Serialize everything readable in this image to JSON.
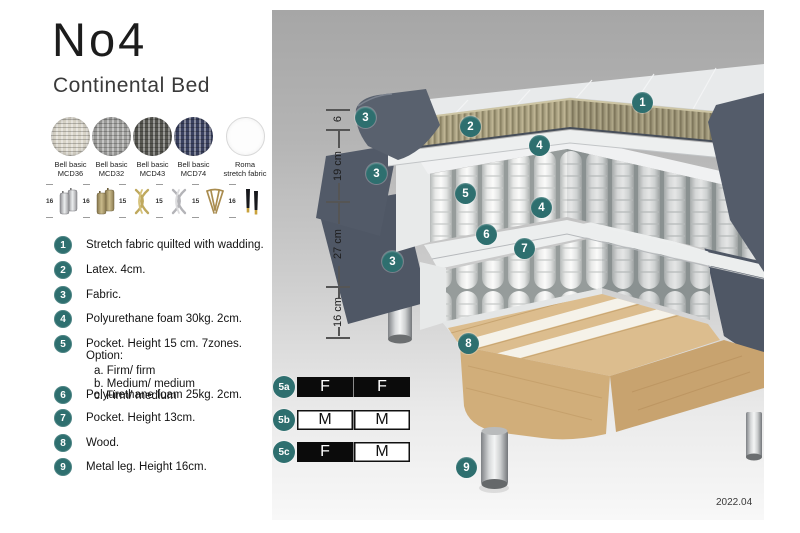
{
  "header": {
    "title": "No4",
    "subtitle": "Continental Bed"
  },
  "fabrics": [
    {
      "name": "Bell basic",
      "code": "MCD36",
      "color": "#d8d4c8"
    },
    {
      "name": "Bell basic",
      "code": "MCD32",
      "color": "#9e9e9c"
    },
    {
      "name": "Bell basic",
      "code": "MCD43",
      "color": "#565650"
    },
    {
      "name": "Bell basic",
      "code": "MCD74",
      "color": "#3a4160"
    },
    {
      "name": "Roma",
      "code": "stretch fabric",
      "color": "#fdfdfd"
    }
  ],
  "leg_options": [
    {
      "height": "16",
      "type": "cylinder-silver"
    },
    {
      "height": "16",
      "type": "cylinder-brass"
    },
    {
      "height": "15",
      "type": "twisted-gold"
    },
    {
      "height": "15",
      "type": "twisted-silver"
    },
    {
      "height": "15",
      "type": "hairpin-metal"
    },
    {
      "height": "16",
      "type": "tapered-black-gold-foot"
    }
  ],
  "parts": [
    {
      "num": "1",
      "text": "Stretch fabric quilted with wadding."
    },
    {
      "num": "2",
      "text": "Latex. 4cm."
    },
    {
      "num": "3",
      "text": "Fabric."
    },
    {
      "num": "4",
      "text": "Polyurethane foam 30kg. 2cm."
    },
    {
      "num": "5",
      "text": "Pocket. Height 15 cm. 7zones. Option:",
      "options": [
        "a. Firm/ firm",
        "b. Medium/ medium",
        "c. Firm/ medium"
      ]
    },
    {
      "num": "6",
      "text": "Polyurethane foam 25kg. 2cm."
    },
    {
      "num": "7",
      "text": "Pocket. Height 13cm."
    },
    {
      "num": "8",
      "text": "Wood."
    },
    {
      "num": "9",
      "text": "Metal leg. Height 16cm."
    }
  ],
  "diagram": {
    "dimensions": [
      "6",
      "19 cm",
      "27 cm",
      "16 cm"
    ],
    "badges": [
      "1",
      "2",
      "3",
      "4",
      "3",
      "5",
      "4",
      "6",
      "7",
      "3",
      "8",
      "9"
    ],
    "firmness": [
      {
        "badge": "5a",
        "cells": [
          {
            "letter": "F",
            "variant": "dark"
          },
          {
            "letter": "F",
            "variant": "dark"
          }
        ]
      },
      {
        "badge": "5b",
        "cells": [
          {
            "letter": "M",
            "variant": "light"
          },
          {
            "letter": "M",
            "variant": "light"
          }
        ]
      },
      {
        "badge": "5c",
        "cells": [
          {
            "letter": "F",
            "variant": "dark"
          },
          {
            "letter": "M",
            "variant": "light"
          }
        ]
      }
    ],
    "date": "2022.04"
  },
  "colors": {
    "accent_teal": "#2e6f6f",
    "fabric_dark": "#545c6a",
    "latex_olive": "#a89f80",
    "wood_tan": "#dcbd8e",
    "panel_gray_top": "#a6a6a6",
    "panel_gray_bottom": "#f8f8f8"
  }
}
